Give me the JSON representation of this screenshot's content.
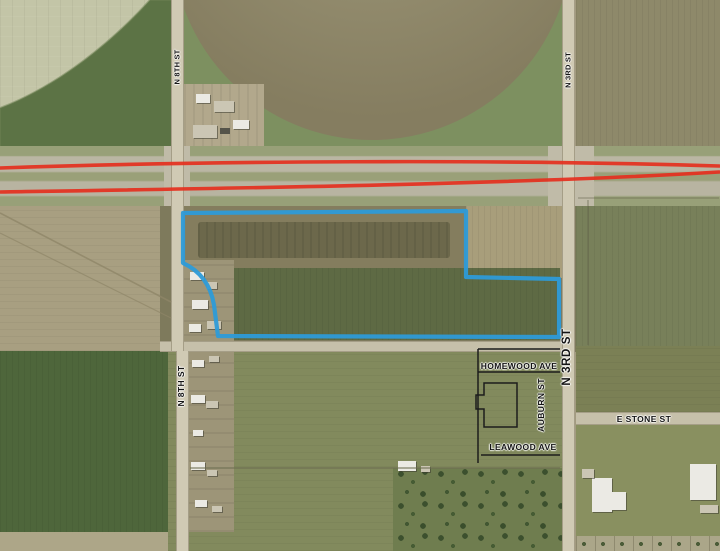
{
  "road_labels": {
    "n8th_top": "N 8TH ST",
    "n3rd_top": "N 3RD ST",
    "n3rd_mid": "N 3RD ST",
    "n8th_bottom": "N 8TH ST",
    "homewood": "HOMEWOOD AVE",
    "auburn": "AUBURN ST",
    "leawood": "LEAWOOD AVE",
    "e_stone": "E STONE ST"
  },
  "overlay_colors": {
    "highway_line": "#e5301f",
    "parcel_outline": "#2d9bd8",
    "plat_lines": "#1c1c1c"
  }
}
